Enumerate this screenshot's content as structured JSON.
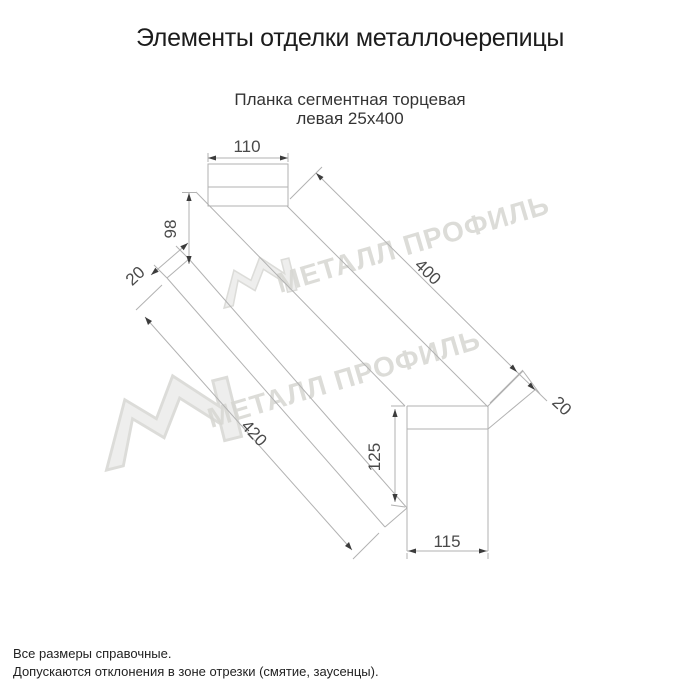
{
  "title": "Элементы отделки металлочерепицы",
  "drawing": {
    "subtitle_line1": "Планка сегментная торцевая",
    "subtitle_line2": "левая 25х400",
    "dimensions": {
      "top_flange_width": "110",
      "left_end_height": "98",
      "left_lip": "20",
      "top_length": "400",
      "bottom_length": "420",
      "right_lip": "20",
      "right_end_height": "125",
      "right_end_width": "115"
    }
  },
  "watermark": {
    "brand_text": "МЕТАЛЛ ПРОФИЛЬ"
  },
  "footer": {
    "note1": "Все размеры справочные.",
    "note2": "Допускаются отклонения в зоне отрезки (смятие, заусенцы)."
  },
  "colors": {
    "line": "#b2b2b2",
    "arrow": "#3c3c3c",
    "dim_text": "#4a4a4a",
    "watermark": "#d7d7d2"
  }
}
